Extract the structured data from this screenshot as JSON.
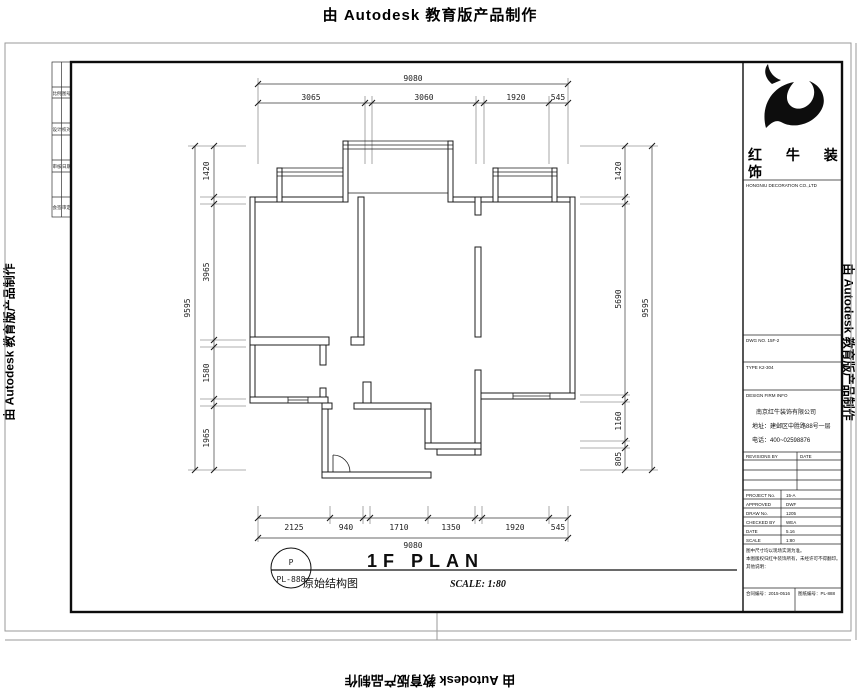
{
  "stamp_text": "由 Autodesk 教育版产品制作",
  "drawing": {
    "title": "1F PLAN",
    "subtitle": "原始结构图",
    "scale_label": "SCALE: 1:80",
    "tag_letter": "P",
    "tag_number": "PL-888"
  },
  "dims": {
    "top": {
      "overall": "9080",
      "segments": [
        "3065",
        "3060",
        "1920",
        "545"
      ]
    },
    "bottom": {
      "overall": "9080",
      "segments": [
        "2125",
        "940",
        "1710",
        "1350",
        "1920",
        "545"
      ]
    },
    "left": {
      "overall": "9595",
      "segments": [
        "1420",
        "3965",
        "1580",
        "1965"
      ]
    },
    "right": {
      "overall": "9595",
      "segments": [
        "1420",
        "5690",
        "1160",
        "805"
      ]
    }
  },
  "title_block": {
    "logo_line1": "红 牛 装",
    "logo_line2": "饰",
    "logo_sub": "HONGNIU DECORATION CO.,LTD",
    "row1": "DWG NO.  15F-2",
    "row2": "TYPE  K2-304",
    "company_header": "DESIGN FIRM INFO",
    "company_lines": [
      "南京红牛装饰有限公司",
      "地址：建邺区中胜路88号一层",
      "电话：400~02598876"
    ],
    "revisions": {
      "col1": "REVISIONS BY",
      "col2": "DATE"
    },
    "fields": [
      {
        "label": "PROJECT No.",
        "value": "15-A"
      },
      {
        "label": "APPROVED",
        "value": "DWF"
      },
      {
        "label": "DRAW No.",
        "value": "1205"
      },
      {
        "label": "CHECKED BY",
        "value": "WEA"
      },
      {
        "label": "DATE",
        "value": "5.16"
      },
      {
        "label": "SCALE",
        "value": "1:80"
      }
    ],
    "notes": [
      "图中尺寸均以现场实测为准。",
      "本图版权归红牛装饰所有，未经许可不得翻印。",
      "其他说明："
    ],
    "bottom_left": "合同编号：2015-0516",
    "bottom_right": "图纸编号：PL-888"
  },
  "side_strip": {
    "rows": [
      [
        "比例",
        "图号"
      ],
      [
        "设计",
        "校对"
      ],
      [
        "审核",
        "日期"
      ],
      [
        "会签",
        "审定"
      ]
    ]
  }
}
